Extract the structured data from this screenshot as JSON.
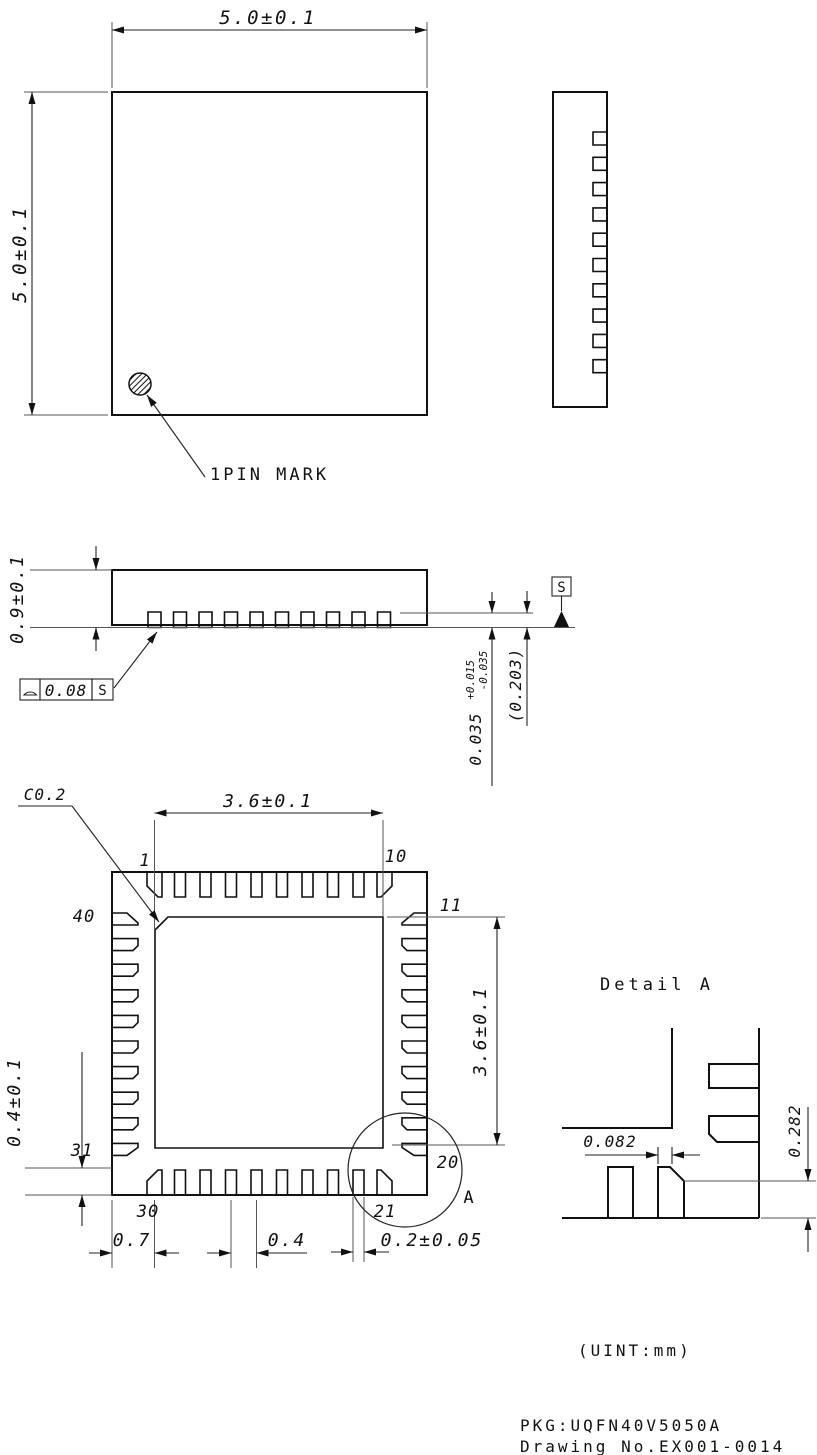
{
  "views": {
    "top_view": {
      "dim_width": "5.0±0.1",
      "dim_height": "5.0±0.1",
      "pin_mark_label": "1PIN MARK"
    },
    "front_view": {
      "dim_height": "0.9±0.1",
      "standoff_main": "0.035",
      "standoff_plus": "+0.015",
      "standoff_minus": "-0.035",
      "ref_dim": "(0.203)",
      "datum_label": "S",
      "fcf_value": "0.08",
      "fcf_datum": "S"
    },
    "bottom_view": {
      "chamfer_label": "C0.2",
      "dim_pad_width": "3.6±0.1",
      "dim_pad_height": "3.6±0.1",
      "dim_corner_offset": "0.4±0.1",
      "dim_edge_to_pin": "0.7",
      "dim_pitch": "0.4",
      "dim_pin_width": "0.2±0.05",
      "detail_ref": "A",
      "pin_labels": {
        "p1": "1",
        "p10": "10",
        "p11": "11",
        "p20": "20",
        "p21": "21",
        "p30": "30",
        "p31": "31",
        "p40": "40"
      }
    },
    "detail_a": {
      "title": "Detail A",
      "dim_chamfer_width": "0.082",
      "dim_chamfer_height": "0.282"
    }
  },
  "footer": {
    "units": "(UINT:mm)",
    "package": "PKG:UQFN40V5050A",
    "drawing_no": "Drawing No.EX001-0014"
  }
}
